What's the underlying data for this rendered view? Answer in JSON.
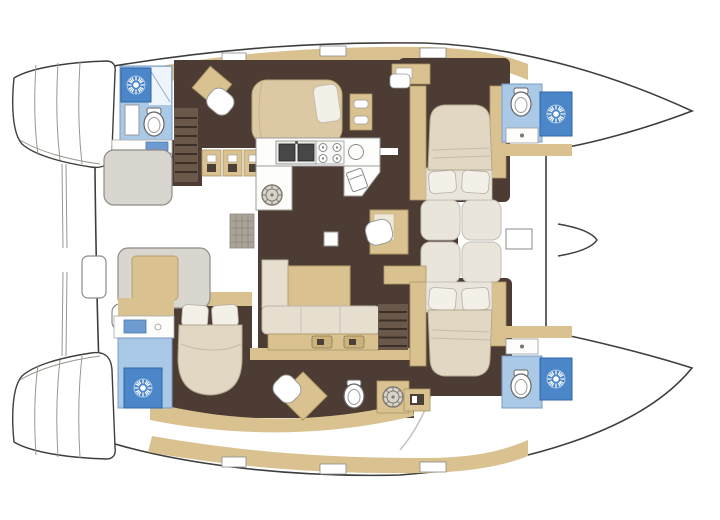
{
  "meta": {
    "title": "Catamaran yacht deck plan",
    "view": "top-down interior floor plan",
    "orientation": "bow-right",
    "visible_text_in_image": "none"
  },
  "palette": {
    "page_bg": "#ffffff",
    "outline": "#3e3e3e",
    "faint_line": "#c9c5bd",
    "step_line": "#9a968e",
    "deck_white": "#ffffff",
    "floor_dark": "#4d3c33",
    "wood": "#d9c28f",
    "wood_edge": "#ab9668",
    "wood_locker": "#c9b27c",
    "bed_beige": "#dcc9a4",
    "bed_head": "#e1d7c3",
    "bed_cream": "#e6dfd0",
    "mattress": "#eae5da",
    "pillow": "#f3f0e8",
    "bath_blue": "#aac9e6",
    "basin_blue": "#6d9bd1",
    "shower_blue": "#4a86c8",
    "counter_white": "#fdfdfb",
    "appliance_dark": "#474747",
    "seat_gray": "#d9d6d0",
    "gray_stroke": "#8e8b86",
    "stairs_brown": "#6a584b",
    "stairs_stripe": "#3c2f27",
    "grate_gray": "#a9a399",
    "icon_dark": "#4a4038"
  },
  "features": {
    "hulls": 2,
    "cabins_with_island_bed": 4,
    "heads_with_shower": 4,
    "saloon_items": [
      "U-shaped galley",
      "double sink",
      "four-burner stove",
      "round sink",
      "fridge",
      "L-shaped sofa",
      "chaise cushion",
      "nav desk with seat",
      "mast step"
    ],
    "cockpit_items": [
      "aft lounge seat",
      "U bench with cushion",
      "side table",
      "side seat",
      "deck grate"
    ],
    "forward_cockpit_items": [
      "four sun cushions",
      "forward beam locker",
      "bowsprit bracket"
    ],
    "transom_items": [
      "port swim steps",
      "starboard swim steps",
      "davit lines"
    ]
  },
  "icons": {
    "shower": "sun-starburst-icon",
    "deck_hatch": "spoked-wheel-hatch-icon",
    "stove": "four-burner-cooktop-icon",
    "galley_sink": "double-basin-sink-icon",
    "toilet": "oval-toilet-icon",
    "fridge": "fridge-square-icon",
    "locker": "drawer-front-icon"
  }
}
